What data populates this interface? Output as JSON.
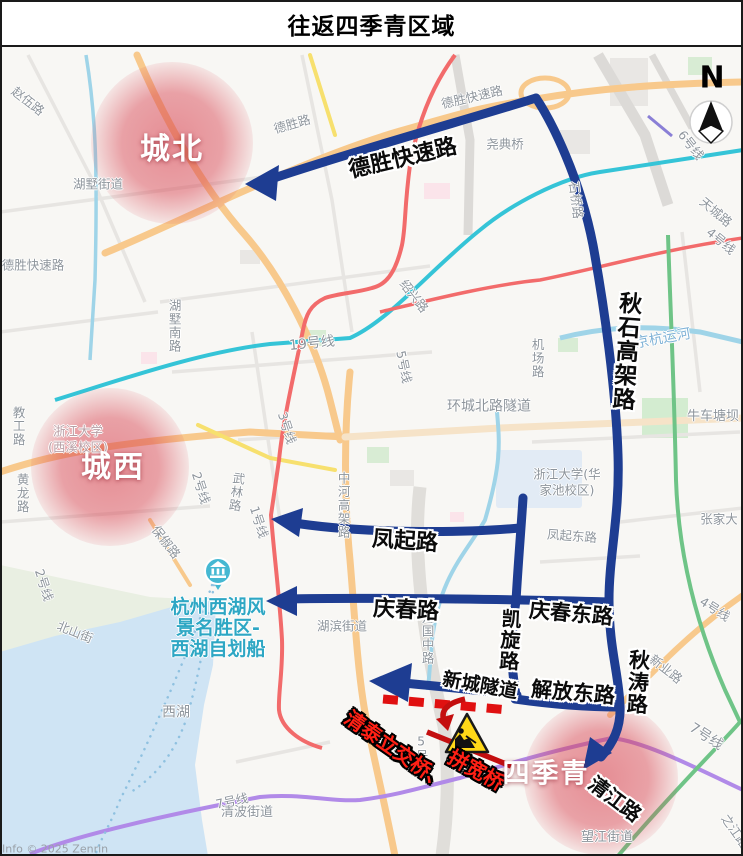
{
  "title": "往返四季青区域",
  "compass_label": "N",
  "attribution": "Info © 2025 Zenrin",
  "zones": {
    "north": "城北",
    "west": "城西",
    "sijiqing": "四季青"
  },
  "annotations": {
    "desheng": "德胜快速路",
    "qiushi": "秋石高架路",
    "fengqi": "凤起路",
    "qingchun": "庆春路",
    "kaixuan": "凯旋路",
    "xincheng": "新城隧道",
    "jiefang": "解放东路",
    "qingchundong": "庆春东路",
    "qiutao": "秋涛路",
    "qingjiang": "清江路"
  },
  "warnings": {
    "part1": "清泰立交桥、",
    "part2": "拼宽桥"
  },
  "map_labels": {
    "zhaowu": "赵伍路",
    "hushu_jiedao": "湖墅街道",
    "desheng_lu": "德胜路",
    "desheng_expwy_map": "德胜快速路",
    "desheng_expwy_left": "德胜快速路",
    "yaodian_bridge": "尧典桥",
    "shiqiao_lu": "石桥路",
    "line6": "6号线",
    "tiancheng_lu": "天城路",
    "line4_ne": "4号线",
    "hushunan_lu": "湖墅南路",
    "line19": "19号线",
    "shaoxing_lu": "绍兴路",
    "line5": "5号线",
    "line3": "3号线",
    "jichang_lu": "机场路",
    "huancheng_tunnel": "环城北路隧道",
    "jinghang_canal": "京杭运河",
    "niuchetang": "牛车塘坝",
    "zheda_huajiachi_1": "浙江大学(华",
    "zheda_huajiachi_2": "家池校区)",
    "jiaogong_lu": "教工路",
    "zheda_xixi_1": "浙江大学",
    "zheda_xixi_2": "(西溪校区)",
    "huanglong_lu": "黄龙路",
    "line2": "2号线",
    "line2_sw": "2号线",
    "wulin_lu": "武林路",
    "line1": "1号线",
    "baochu_lu": "保俶路",
    "zhonghe_viaduct": "中河高架路",
    "fengqidong_lu": "凤起东路",
    "hubin_jiedao": "湖滨街道",
    "jianguozhong_lu": "建国中路",
    "westlake_poi_1": "杭州西湖风",
    "westlake_poi_2": "景名胜区-",
    "westlake_poi_3": "西湖自划船",
    "beishan_jie": "北山街",
    "xihu": "西湖",
    "qingbo_jiedao": "清波街道",
    "line7_w": "7号线",
    "line5_s": "5号线",
    "wangjiang_jiedao": "望江街道",
    "xinye_lu": "新业路",
    "line7_se": "7号线",
    "zhangjia": "张家大",
    "zhijiang_lu": "之江路",
    "line4_e": "4号线"
  },
  "colors": {
    "route_blue": "#1e3d92",
    "warning_red": "#d41111",
    "zone_red": "#d8404e",
    "poi_teal": "#45b8d2"
  }
}
